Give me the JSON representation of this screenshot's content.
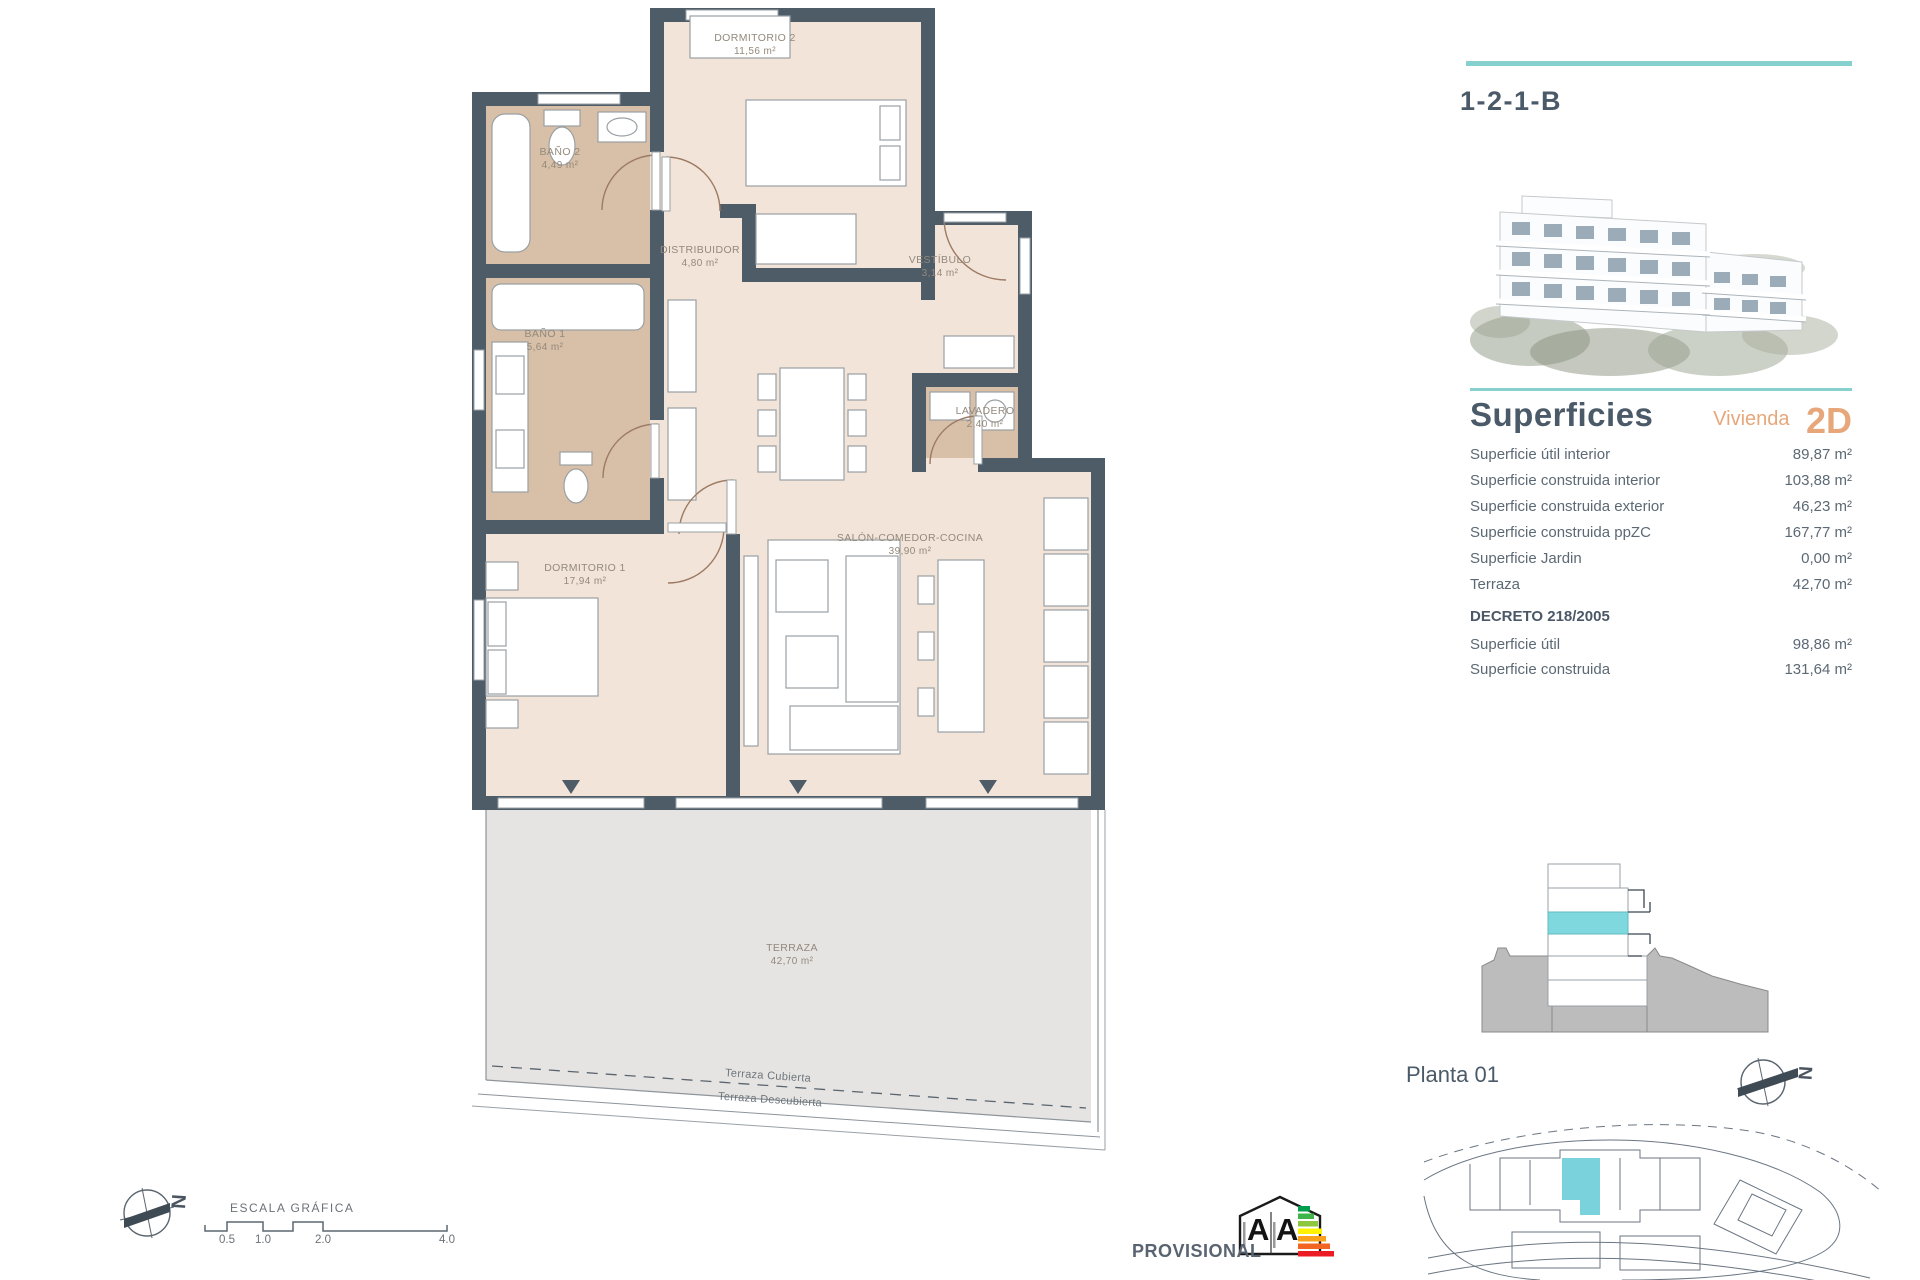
{
  "unit": {
    "code": "1-2-1-B"
  },
  "panel": {
    "superficies_heading": "Superficies",
    "vivienda_label": "Vivienda",
    "vivienda_code": "2D",
    "rows": [
      {
        "label": "Superficie útil interior",
        "value": "89,87 m²"
      },
      {
        "label": "Superficie construida interior",
        "value": "103,88 m²"
      },
      {
        "label": "Superficie construida exterior",
        "value": "46,23 m²"
      },
      {
        "label": "Superficie construida ppZC",
        "value": "167,77 m²"
      },
      {
        "label": "Superficie Jardin",
        "value": "0,00 m²"
      },
      {
        "label": "Terraza",
        "value": "42,70 m²"
      }
    ],
    "decreto_heading": "DECRETO 218/2005",
    "decreto_rows": [
      {
        "label": "Superficie útil",
        "value": "98,86 m²"
      },
      {
        "label": "Superficie construida",
        "value": "131,64 m²"
      }
    ],
    "planta_label": "Planta 01"
  },
  "floorplan": {
    "rooms": [
      {
        "name": "DORMITORIO 2",
        "area": "11,56 m²"
      },
      {
        "name": "BAÑO 2",
        "area": "4,49 m²"
      },
      {
        "name": "DISTRIBUIDOR",
        "area": "4,80 m²"
      },
      {
        "name": "VESTÍBULO",
        "area": "3,14 m²"
      },
      {
        "name": "BAÑO 1",
        "area": "5,64 m²"
      },
      {
        "name": "LAVADERO",
        "area": "2,40 m²"
      },
      {
        "name": "SALÓN-COMEDOR-COCINA",
        "area": "39,90 m²"
      },
      {
        "name": "DORMITORIO 1",
        "area": "17,94 m²"
      },
      {
        "name": "TERRAZA",
        "area": "42,70 m²"
      }
    ],
    "terrace_covered": "Terraza Cubierta",
    "terrace_uncovered": "Terraza Descubierta"
  },
  "scalebar": {
    "label": "ESCALA GRÁFICA",
    "ticks": [
      "0.5",
      "1.0",
      "2.0",
      "4.0"
    ]
  },
  "footer": {
    "provisional": "PROVISIONAL"
  },
  "energy": {
    "letter_left": "A",
    "letter_right": "A"
  },
  "compass": {
    "letter": "N"
  },
  "colors": {
    "accent_teal": "#86d0ce",
    "heading": "#4b5a68",
    "accent_orange": "#e7a77b",
    "wall": "#4e5c68",
    "room_beige": "#f2e4d9",
    "bath_tan": "#d8bfa7",
    "terrace_gray": "#e5e4e2",
    "highlight_cyan": "#7ad2dc"
  }
}
